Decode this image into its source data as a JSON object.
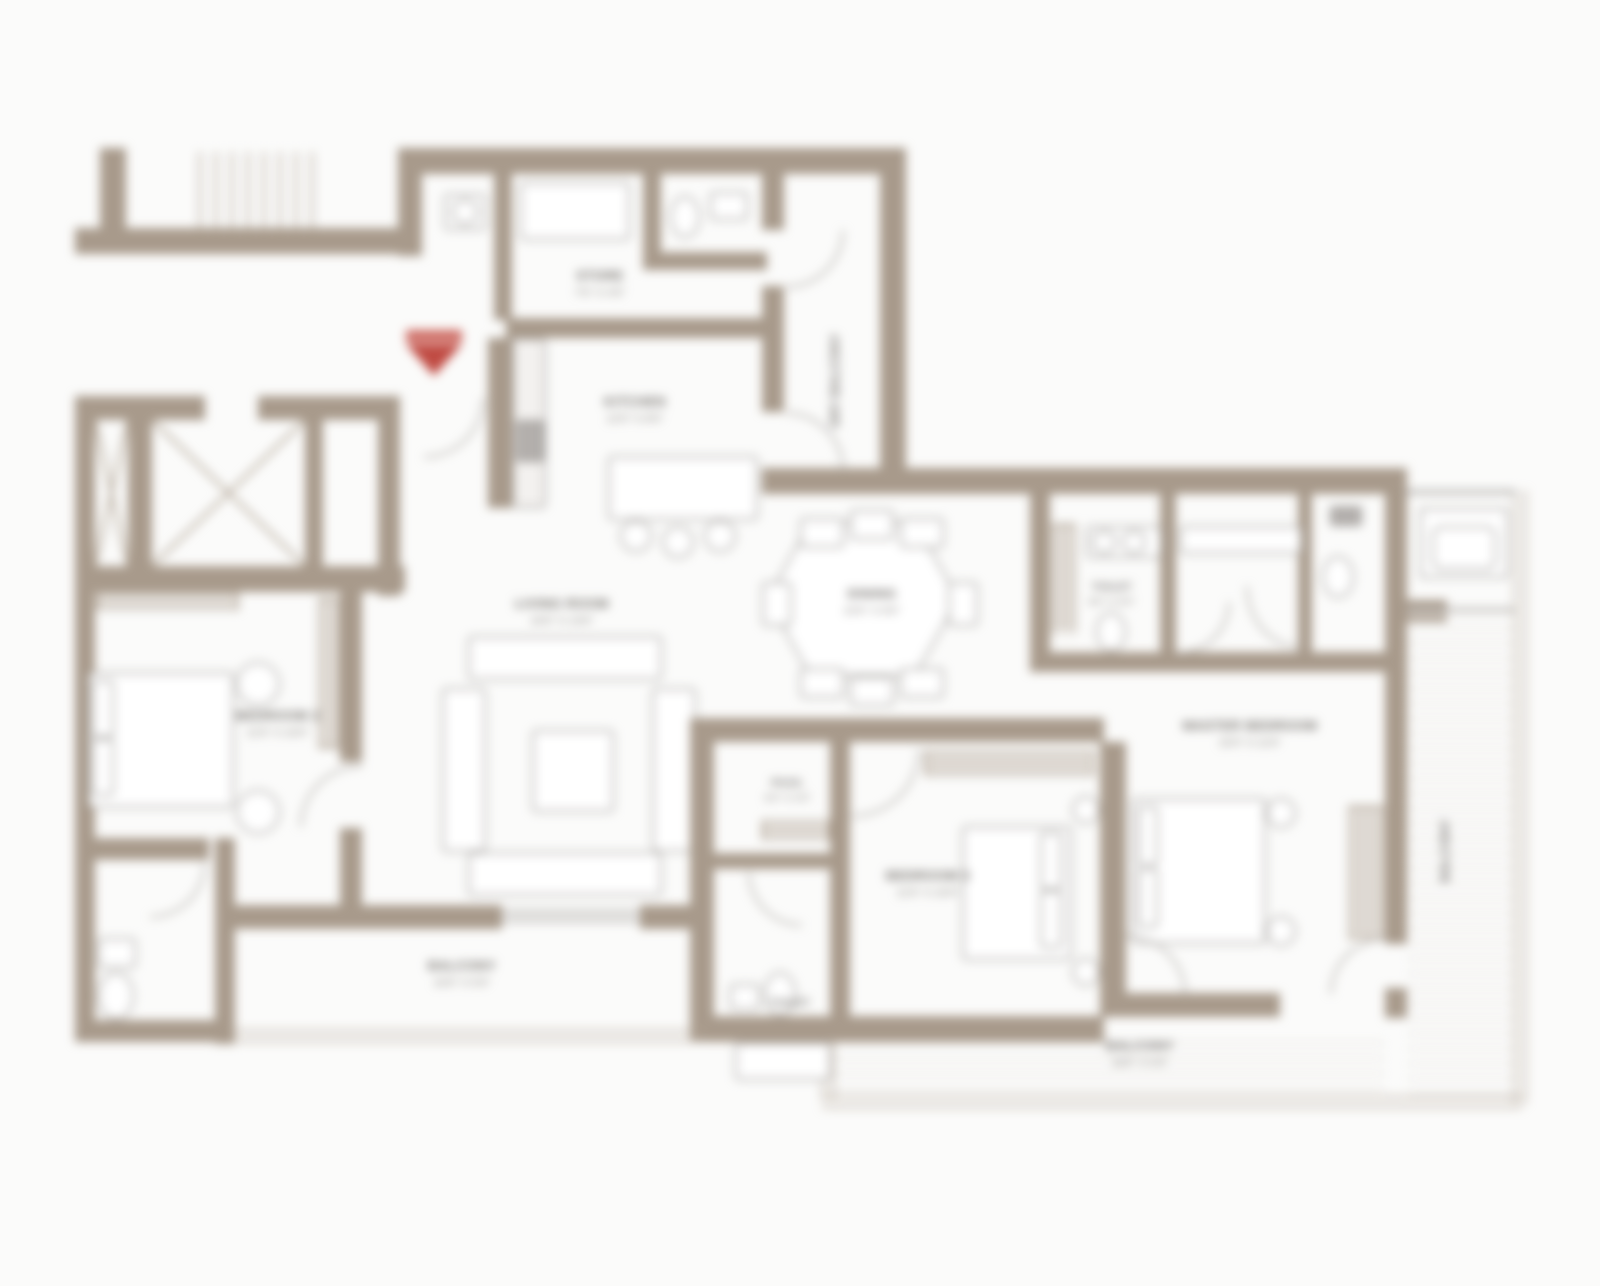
{
  "plan": {
    "type": "apartment-floor-plan",
    "palette": {
      "wall": "#a89a8b",
      "wall_light": "#b8ab9c",
      "furniture_line": "#a6a3a0",
      "text": "#6f6b67",
      "entry_accent": "#c04b43",
      "background": "#fbfbfa",
      "floor": "#ffffff"
    },
    "entry_marker": "entry-arrow"
  },
  "rooms": {
    "store": {
      "label": "STORE",
      "dim": "7'6\" X 4'6\""
    },
    "kitchen": {
      "label": "KITCHEN",
      "dim": "12'0\" X 8'0\""
    },
    "dry_balcony": {
      "label": "DRY BALCONY"
    },
    "living": {
      "label": "LIVING ROOM",
      "dim": "16'6\" X 13'6\""
    },
    "dining": {
      "label": "DINING",
      "dim": "10'6\" X 8'6\""
    },
    "bedroom2": {
      "label": "BEDROOM 2",
      "dim": "11'6\" X 10'0\""
    },
    "bedroom3": {
      "label": "BEDROOM 3",
      "dim": "11'6\" X 10'0\""
    },
    "master": {
      "label": "MASTER BEDROOM",
      "dim": "15'0\" X 11'6\""
    },
    "toilet_master": {
      "label": "TOILET",
      "dim": "8'0\" X 5'0\""
    },
    "passage": {
      "label": "PASS.",
      "dim": "6'0\" X 4'0\""
    },
    "toilet_common": {
      "label": "TOILET"
    },
    "balcony_left": {
      "label": "BALCONY",
      "dim": "15'6\" X 5'0\""
    },
    "balcony_right": {
      "label": "BALCONY",
      "dim": "18'6\" X 5'0\""
    },
    "balcony_side": {
      "label": "BALCONY"
    }
  }
}
